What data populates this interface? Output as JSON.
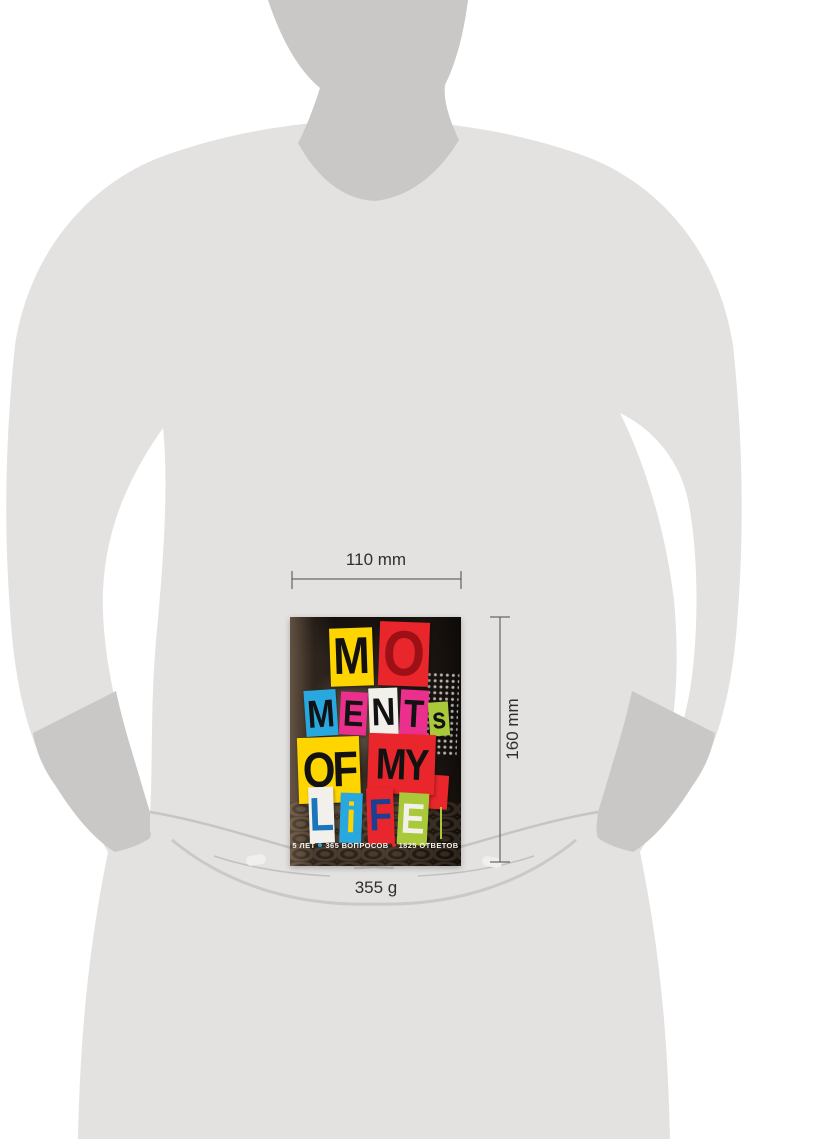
{
  "product_view": {
    "dimensions": {
      "width_label": "110 mm",
      "height_label": "160 mm",
      "weight_label": "355 g"
    },
    "cover": {
      "title": "MOMENTS OF MY LIFE",
      "blocks": [
        {
          "letter": "M",
          "bg": "#ffd500",
          "fg": "#121212"
        },
        {
          "letter": "O",
          "bg": "#e8262b",
          "fg": "#9d1016"
        },
        {
          "letter": "M",
          "bg": "#29a8df",
          "fg": "#121212"
        },
        {
          "letter": "E",
          "bg": "#ea2f8c",
          "fg": "#121212"
        },
        {
          "letter": "N",
          "bg": "#f2f0ea",
          "fg": "#121212"
        },
        {
          "letter": "T",
          "bg": "#ea2f8c",
          "fg": "#121212"
        },
        {
          "letter": "s",
          "bg": "#a9c93a",
          "fg": "#121212"
        },
        {
          "letter": "OF",
          "bg": "#ffd500",
          "fg": "#121212"
        },
        {
          "letter": "MY",
          "bg": "#e8262b",
          "fg": "#121212"
        },
        {
          "letter": "L",
          "bg": "#f2f0ea",
          "fg": "#1b75bb"
        },
        {
          "letter": "i",
          "bg": "#29a8df",
          "fg": "#ffd500"
        },
        {
          "letter": "F",
          "bg": "#e8262b",
          "fg": "#1c3f94"
        },
        {
          "letter": "E",
          "bg": "#a9c93a",
          "fg": "#f2f0ea"
        }
      ],
      "tagline": {
        "part1": "5 ЛЕТ",
        "part2": "365 ВОПРОСОВ",
        "part3": "1825 ОТВЕТОВ",
        "dot1_color": "#29a8df",
        "dot2_color": "#e8262b"
      }
    },
    "colors": {
      "silhouette_body": "#e3e2e0",
      "silhouette_shade": "#c9c8c6",
      "dimension_line": "#4a4a4a"
    }
  }
}
